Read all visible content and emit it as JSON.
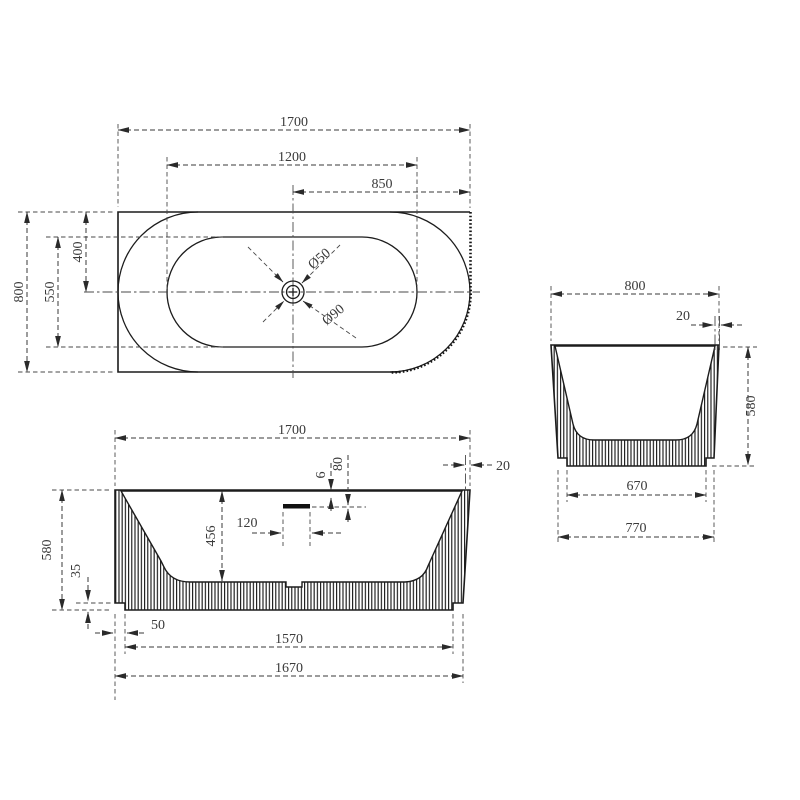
{
  "drawing": {
    "background": "#ffffff",
    "line_color": "#1c1c1c",
    "dim_color": "#3a3a3a",
    "views": {
      "plan": {
        "dims": {
          "overall_length": "1700",
          "basin_length": "1200",
          "drain_to_end": "850",
          "overall_width": "800",
          "basin_width": "550",
          "centerline_offset": "400",
          "waste_diameter": "Ø50",
          "flange_diameter": "Ø90"
        }
      },
      "front": {
        "dims": {
          "overall_length": "1700",
          "rim_thickness": "20",
          "overflow_drop": "80",
          "overflow_lip": "6",
          "overflow_width": "120",
          "basin_depth": "456",
          "overall_height": "580",
          "plinth_height": "35",
          "plinth_inset": "50",
          "plinth_length": "1570",
          "base_length": "1670"
        }
      },
      "side": {
        "dims": {
          "overall_width": "800",
          "rim_thickness": "20",
          "overall_height": "580",
          "plinth_width": "670",
          "base_width": "770"
        }
      }
    }
  }
}
